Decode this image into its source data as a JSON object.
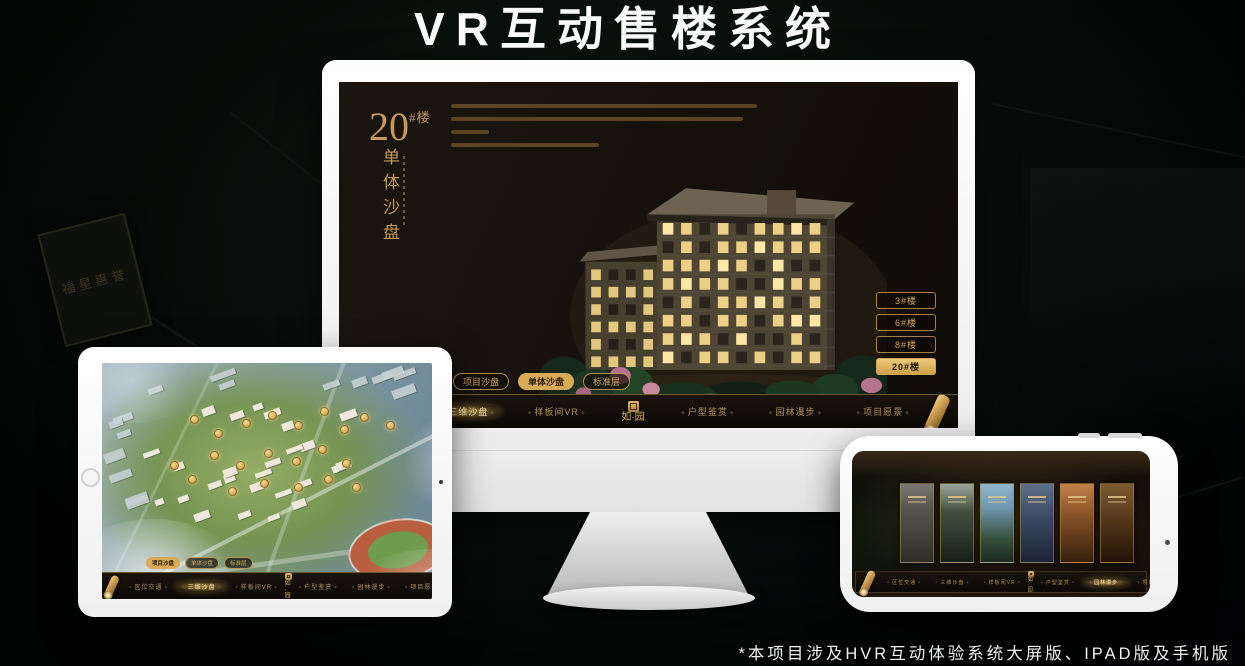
{
  "page": {
    "title": "VR互动售楼系统",
    "footnote": "*本项目涉及HVR互动体验系统大屏版、IPAD版及手机版"
  },
  "brand": {
    "logo": "如·园"
  },
  "nav": {
    "items": [
      "区位交通",
      "三维沙盘",
      "样板间VR",
      "户型鉴赏",
      "园林漫步",
      "项目愿景"
    ]
  },
  "monitor": {
    "building_no": "20",
    "building_no_suffix": "#楼",
    "section_title": "单体沙盘",
    "sub_tabs": [
      "项目沙盘",
      "单体沙盘",
      "标准层"
    ],
    "floor_buttons": [
      "3#楼",
      "6#楼",
      "8#楼",
      "20#楼"
    ]
  },
  "background": {
    "plaque_text": "福星惠誉"
  },
  "colors": {
    "gold": "#c9a063",
    "gold_active": "#d9ab55",
    "screen_bg": "#171208",
    "page_bg": "#070c09"
  },
  "icons": {
    "scroll": "scroll-ornament-icon",
    "seal": "seal-stamp-icon",
    "home": "home-button",
    "camera": "camera-dot-icon"
  }
}
